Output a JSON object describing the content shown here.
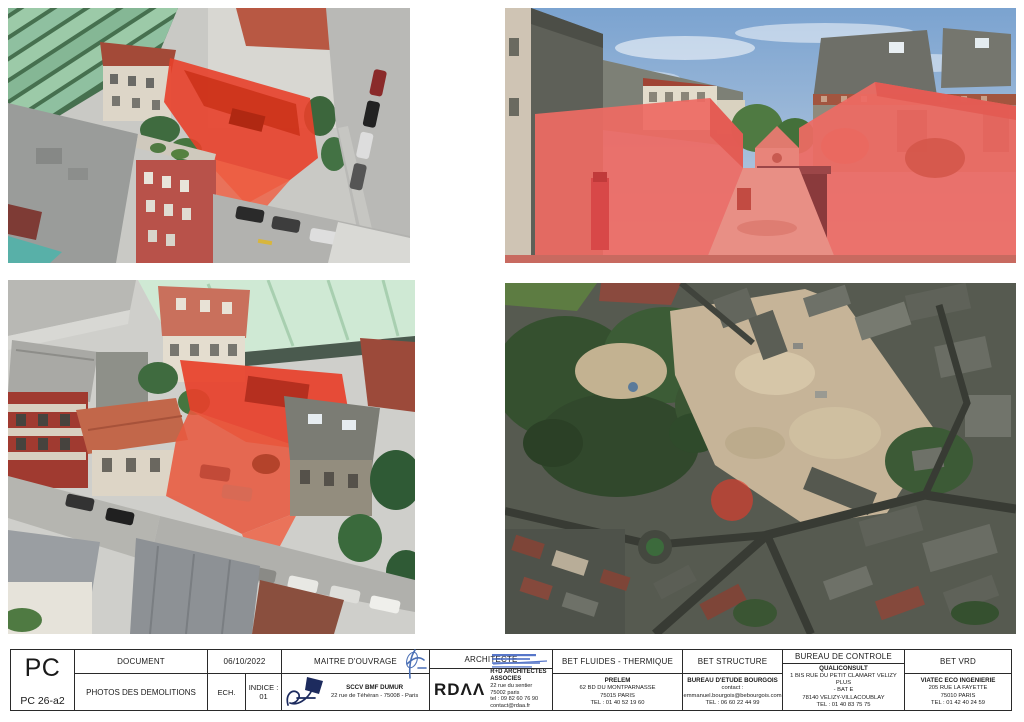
{
  "colors": {
    "demolition_overlay_red": "#e8402a",
    "streetview_overlay_pink": "#ee6a63",
    "site_marker_red": "#e83a2a",
    "stamp_blue": "#3a5fc0",
    "signature_navy": "#1d2b5e"
  },
  "photos": {
    "count": 4,
    "top_left": "aerial-3d-view-demolition-highlight",
    "top_right": "street-view-demolition-highlight",
    "bottom_left": "aerial-3d-closeup-demolition-highlight",
    "bottom_right": "satellite-map-site-marker"
  },
  "titleblock": {
    "code": "PC",
    "ref": "PC 26-a2",
    "document": {
      "label": "DOCUMENT",
      "value": "PHOTOS DES DEMOLITIONS"
    },
    "date": "06/10/2022",
    "ech": {
      "label": "ECH."
    },
    "indice": {
      "label": "INDICE :",
      "value": "01"
    },
    "maitre_douvrage": {
      "label": "MAITRE D'OUVRAGE",
      "name": "SCCV BMF DUMUR",
      "address": "22 rue de Téhéran - 75008 - Paris"
    },
    "architecte": {
      "label": "ARCHITECTE",
      "logo_text": "RDΛΛ",
      "name": "R+D ARCHITECTES ASSOCIES",
      "lines": [
        "22 rue du sentier",
        "75002 paris",
        "tel : 09 82 60 76 90",
        "contact@rdaa.fr"
      ]
    },
    "bet_fluides": {
      "label": "BET FLUIDES - THERMIQUE",
      "name": "PRELEM",
      "lines": [
        "62 BD DU MONTPARNASSE",
        "75015 PARIS",
        "TEL : 01 40 52 19 60"
      ]
    },
    "bet_structure": {
      "label": "BET STRUCTURE",
      "name": "BUREAU D'ETUDE BOURGOIS",
      "lines": [
        "contact : emmanuel.bourgois@bebourgois.com",
        "TEL : 06 60 22 44 99"
      ]
    },
    "bureau_controle": {
      "label": "BUREAU DE CONTROLE",
      "name": "QUALICONSULT",
      "lines": [
        "1 BIS RUE DU PETIT CLAMART VELIZY PLUS",
        "- BAT E",
        "78140 VELIZY-VILLACOUBLAY",
        "TEL : 01 40 83 75 75"
      ]
    },
    "bet_vrd": {
      "label": "BET VRD",
      "name": "VIATEC ECO INGENIERIE",
      "lines": [
        "205 RUE LA FAYETTE",
        "75010 PARIS",
        "TEL : 01 42 40 24 59"
      ]
    }
  }
}
